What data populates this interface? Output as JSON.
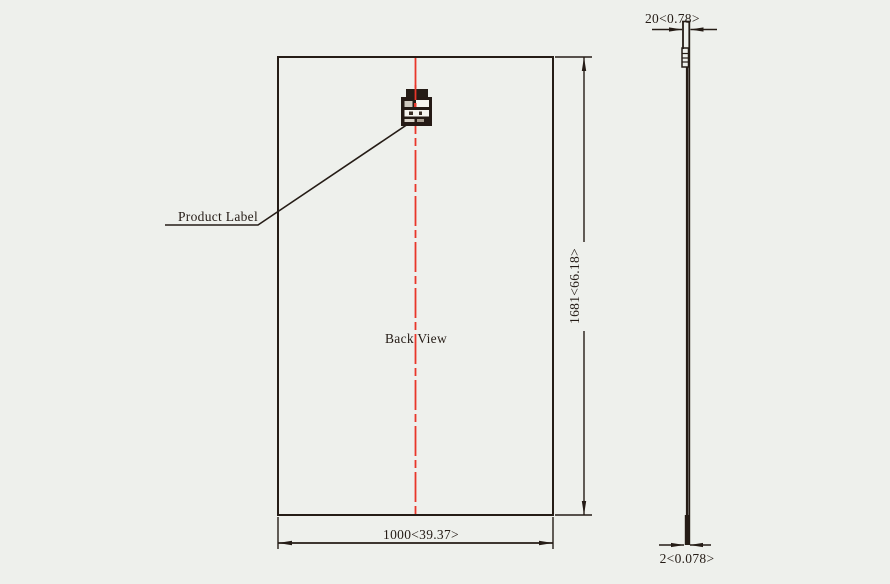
{
  "drawing": {
    "colors": {
      "background": "#eef0ec",
      "line": "#251c16",
      "centerline_red": "#e8362a",
      "label_body": "#251a15",
      "label_paper": "#f6f4ef"
    },
    "back_view": {
      "view_label": "Back View",
      "product_label_callout": "Product Label"
    },
    "dimensions": {
      "panel_height": "1681<66.18>",
      "panel_width": "1000<39.37>",
      "edge_top_thickness": "20<0.78>",
      "edge_bottom_thickness": "2<0.078>"
    }
  }
}
